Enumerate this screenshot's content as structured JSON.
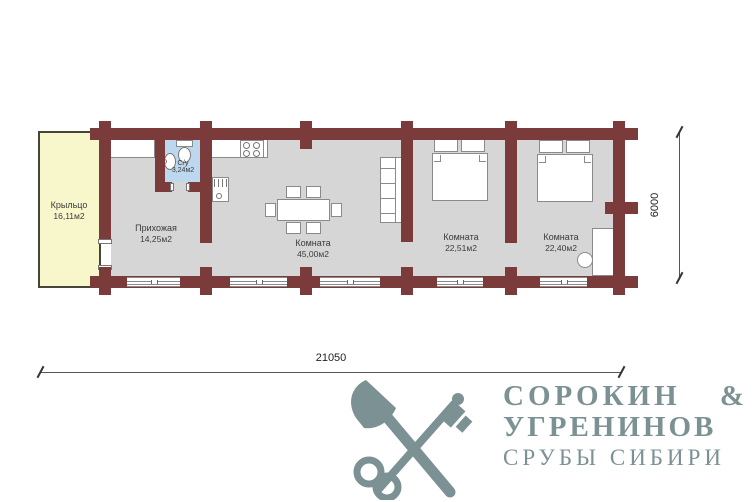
{
  "plan": {
    "rooms": [
      {
        "name": "Крыльцо",
        "area": "16,11м2"
      },
      {
        "name": "Прихожая",
        "area": "14,25м2"
      },
      {
        "name": "С/у",
        "area": "3,24м2"
      },
      {
        "name": "Комната",
        "area": "45,00м2"
      },
      {
        "name": "Комната",
        "area": "22,51м2"
      },
      {
        "name": "Комната",
        "area": "22,40м2"
      }
    ],
    "dimensions": {
      "width_mm": "21050",
      "height_mm": "6000"
    }
  },
  "logo": {
    "name1": "СОРОКИН",
    "amp": "&",
    "name2": "УГРЕНИНОВ",
    "tagline": "СРУБЫ СИБИРИ"
  },
  "colors": {
    "wall": "#7b3b3b",
    "floor": "#d6d6d6",
    "porch": "#f7f7cb",
    "porchborder": "#45453a",
    "bath": "#bdd8ee",
    "line": "#8a8a8a",
    "text": "#3b3b3b",
    "logo": "#7c9193"
  }
}
